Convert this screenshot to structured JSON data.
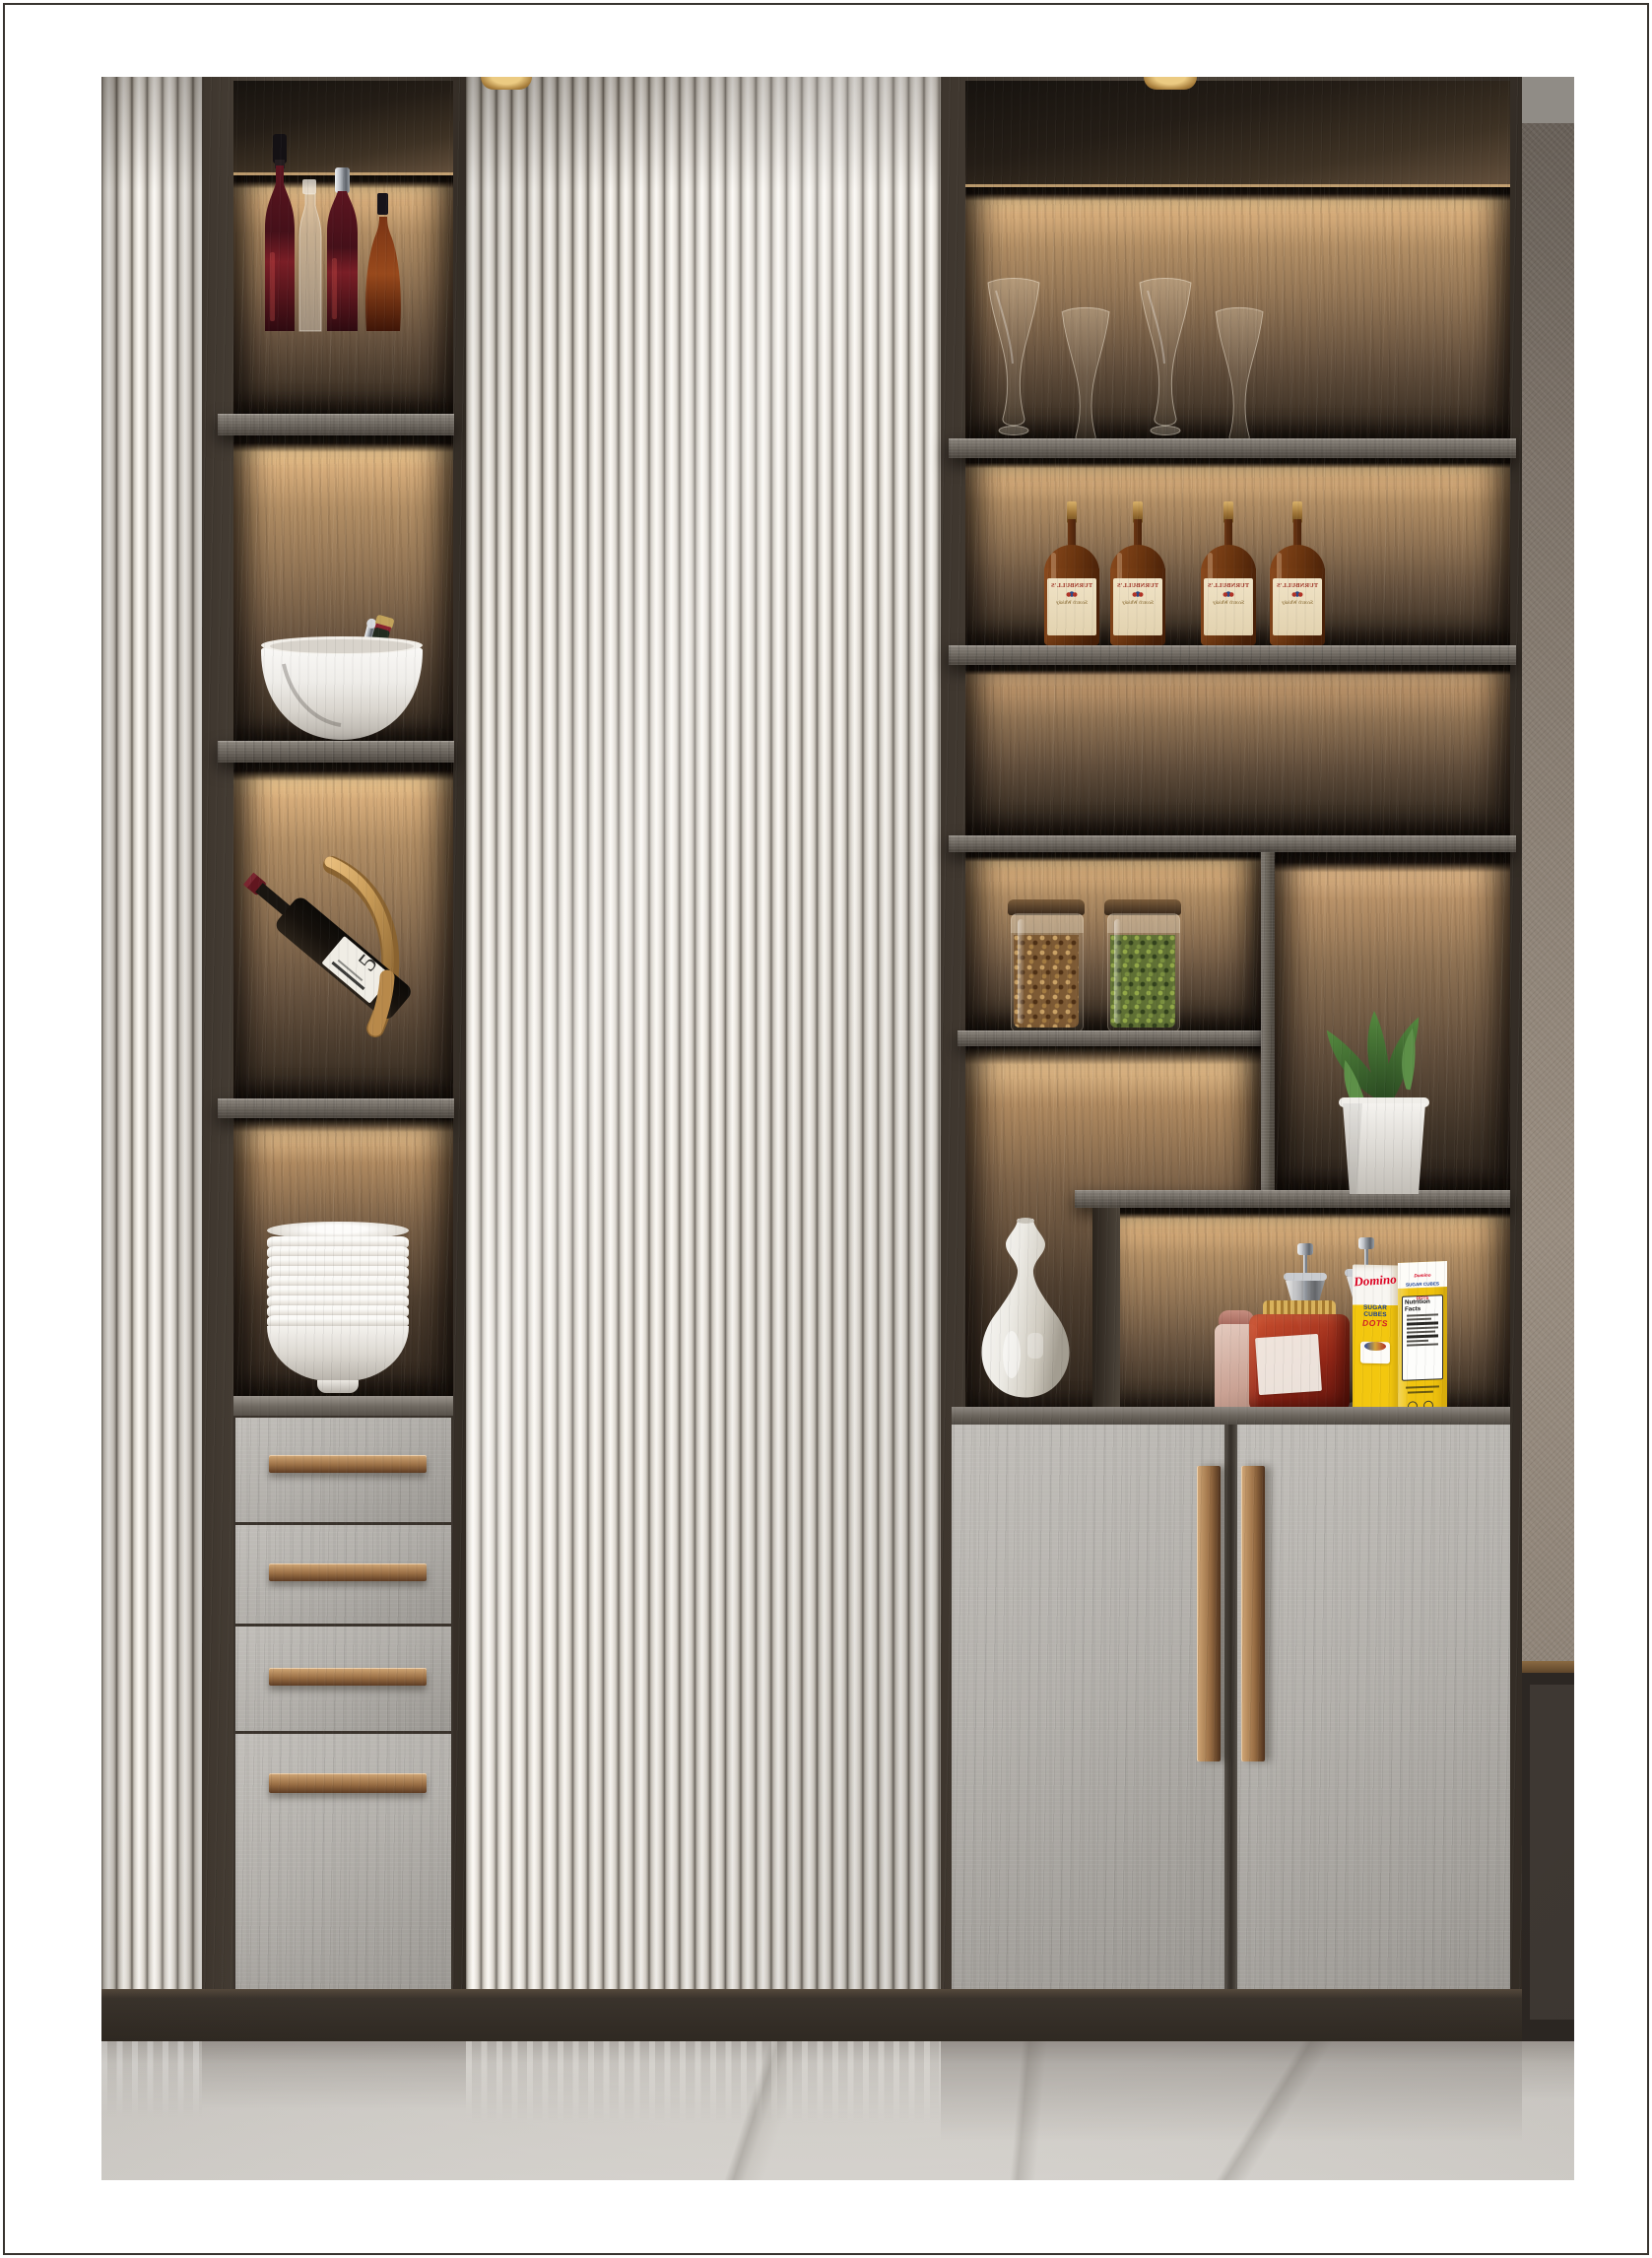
{
  "scene": {
    "description": "Photoreal interior render: built-in bar and display cabinetry with ivory fluted panels, LED-lit walnut niches, grey stone fronts with bronze handles, marble floor",
    "palette": {
      "fluted_ivory": "#ece8e1",
      "dark_wood": "#443c34",
      "shelf_grey_wood": "#6e6860",
      "led_glow": "#d9b384",
      "stone_front_grey": "#b3b0ab",
      "bronze": "#9a6f45",
      "marble_floor": "#cecbc6",
      "accent_wall": "#8d8276"
    },
    "left_column": {
      "shelves": [
        {
          "items": "red and amber liquor bottles",
          "count": 4
        },
        {
          "items": "white ice bucket with champagne bottle and tongs",
          "count": 1
        },
        {
          "items": "wine bottle on curved brass display stand",
          "count": 1
        },
        {
          "items": "stacked white ceramic bowls",
          "count": 11
        }
      ],
      "drawers": {
        "count": 4,
        "handle_style": "horizontal bronze bar"
      }
    },
    "center_door": {
      "type": "full-height fluted ivory panel"
    },
    "right_section": {
      "glassware_count": 4,
      "whisky_bottle_count": 4,
      "jars": [
        {
          "contents": "roasted nuts"
        },
        {
          "contents": "dried herbs"
        }
      ],
      "plant": "succulent in white pot",
      "niche_items": [
        "chrome brew stands",
        "pink canister",
        "amber candy jar",
        "sugar cube box",
        "white vase"
      ],
      "doors": {
        "count": 2,
        "handle_style": "vertical bronze bar"
      }
    },
    "whisky_label": {
      "brand": "TURNBULL'S",
      "subtitle": "Scotch Whisky",
      "mirrored": true
    },
    "wine_display": {
      "label_numeral": "5"
    },
    "sugar_box": {
      "brand": "Domino",
      "product": "SUGAR CUBES",
      "variant": "DOTS",
      "top_flap_brand": "Domino",
      "top_flap_product": "SUGAR CUBES",
      "top_flap_variant": "DOTS",
      "nutrition_title": "Nutrition Facts"
    }
  }
}
